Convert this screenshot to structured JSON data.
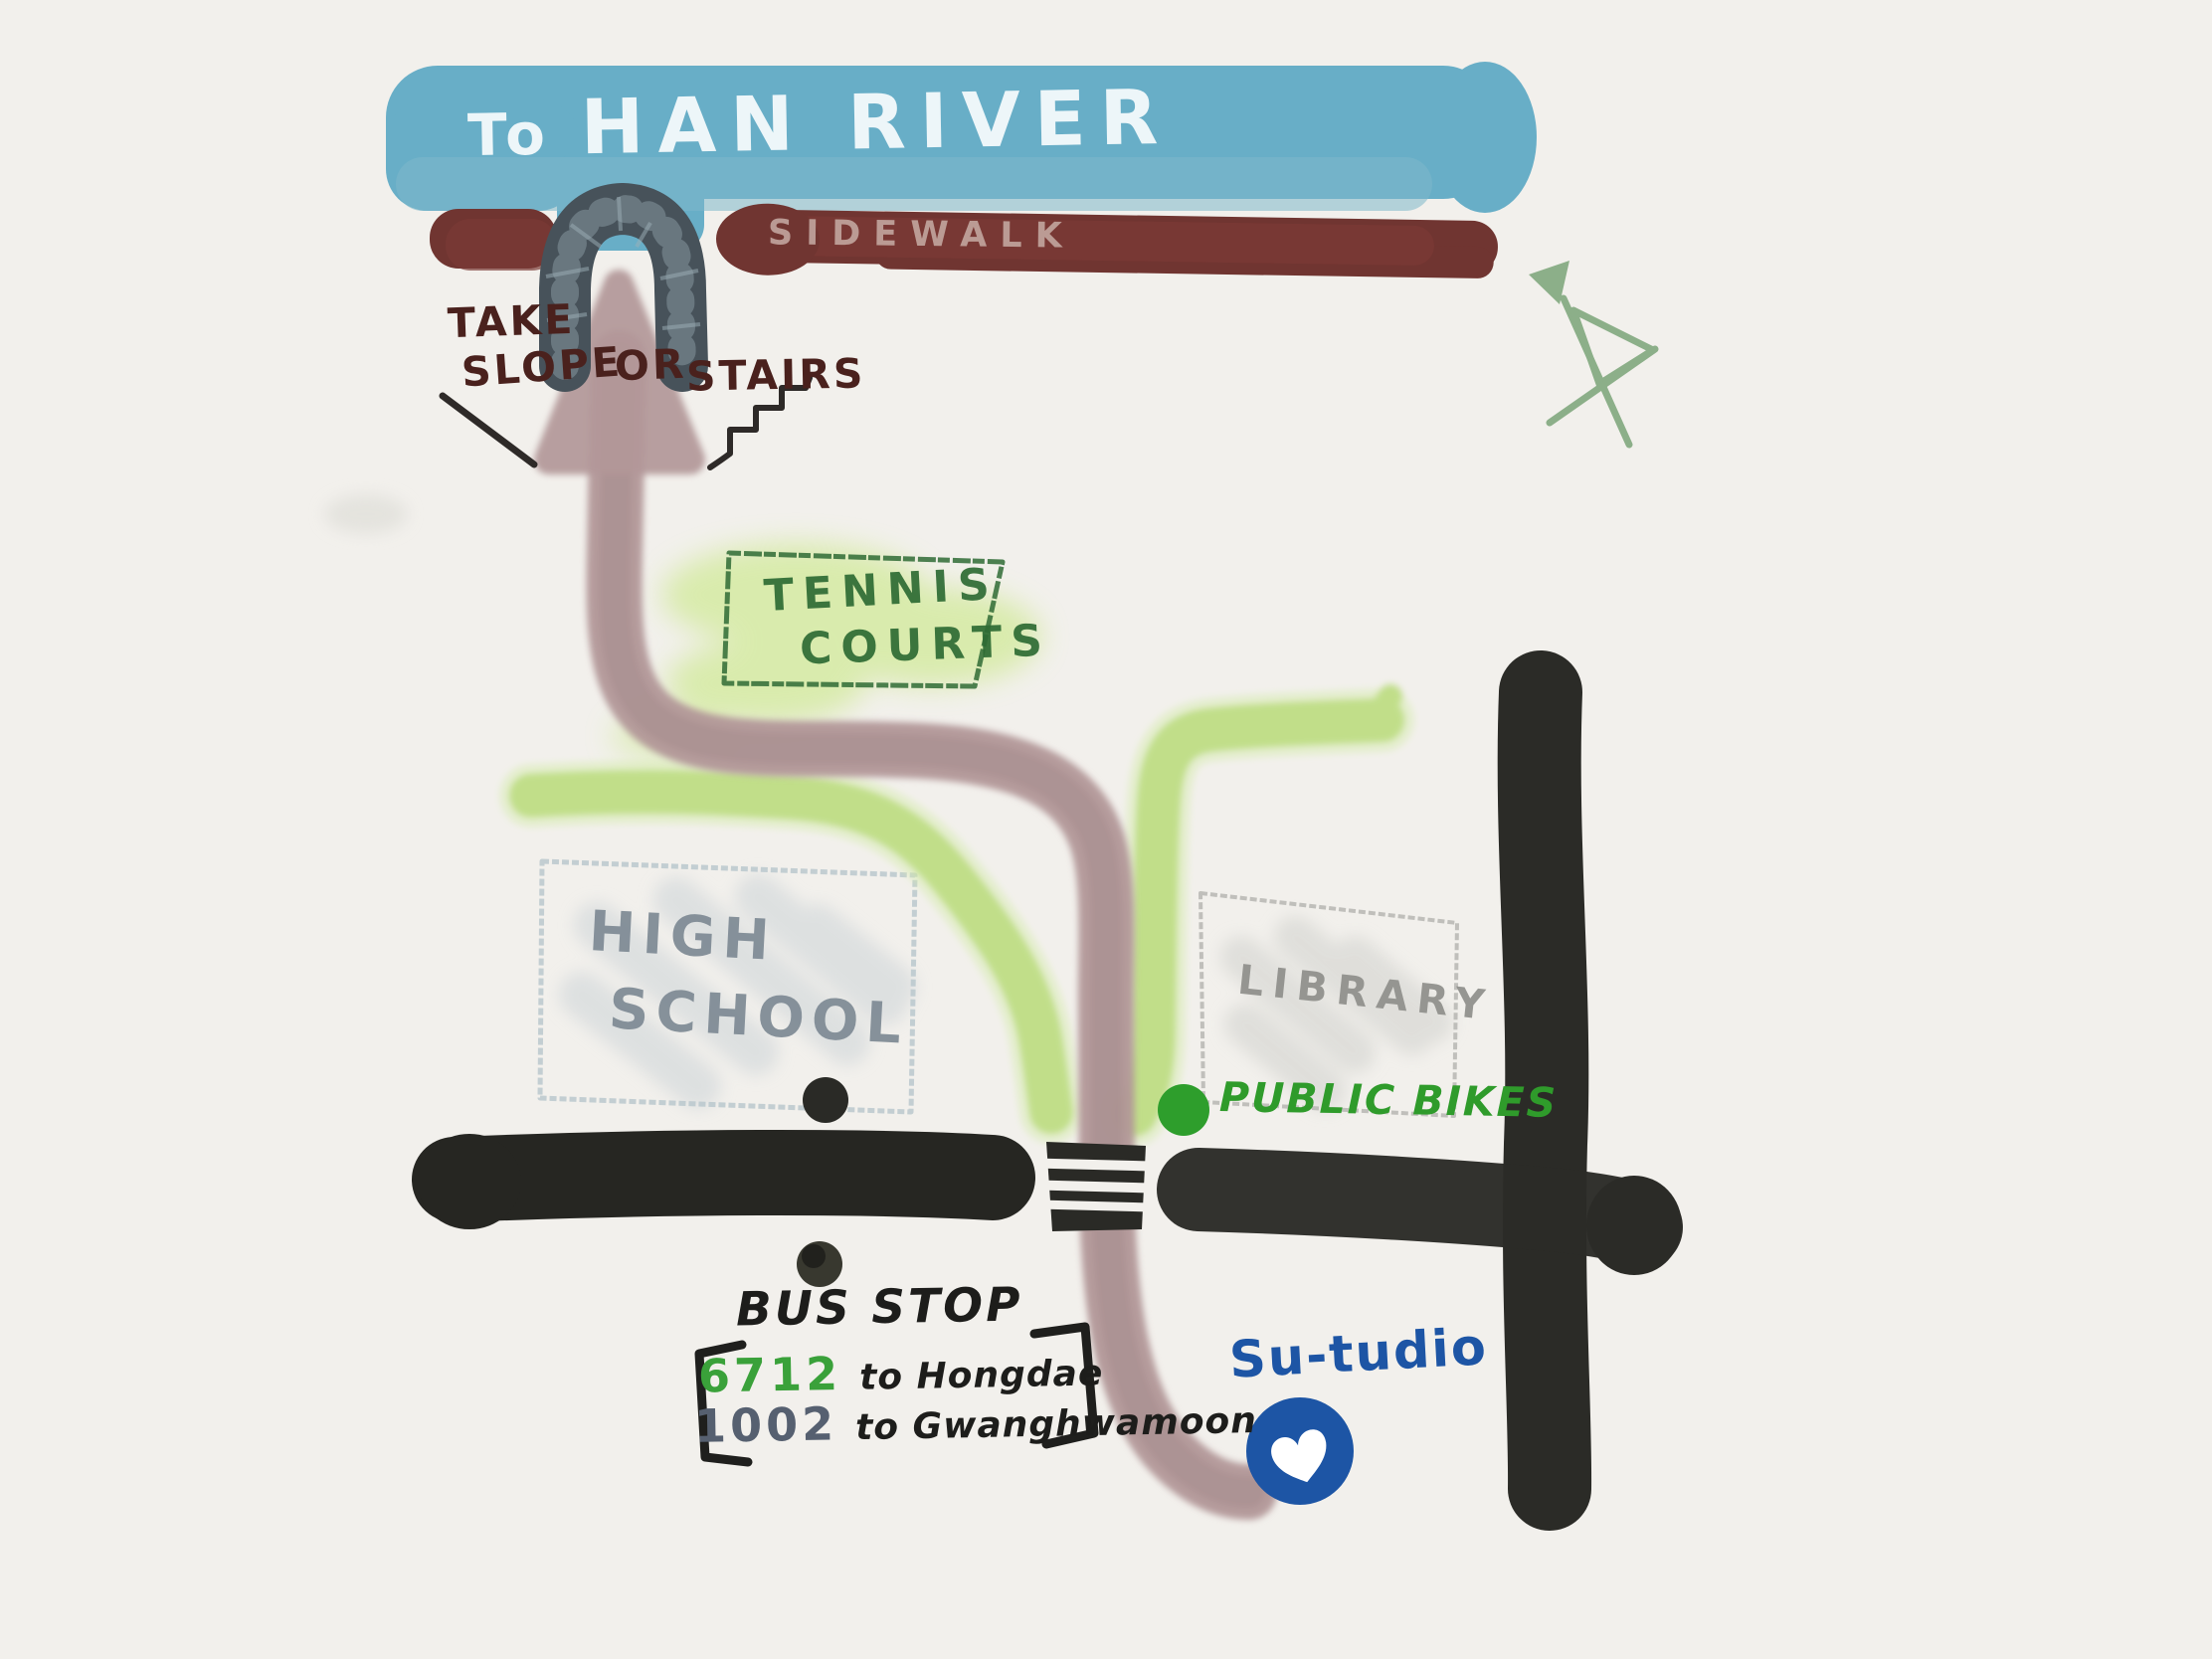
{
  "map": {
    "river": {
      "prefix": "To",
      "name": "HAN RIVER"
    },
    "sidewalk": {
      "label": "SIDEWALK"
    },
    "access_note": {
      "take": "TAKE",
      "slope": "SLOPE",
      "or": "OR",
      "stairs": "STAIRS"
    },
    "tennis_courts": {
      "line1": "TENNIS",
      "line2": "COURTS"
    },
    "high_school": {
      "line1": "HIGH",
      "line2": "SCHOOL"
    },
    "library": {
      "label": "LIBRARY"
    },
    "public_bikes": {
      "label": "PUBLIC BIKES"
    },
    "bus_stop": {
      "label": "BUS STOP",
      "routes": [
        {
          "number": "6712",
          "destination": "to Hongdae"
        },
        {
          "number": "1002",
          "destination": "to Gwanghwamoon"
        }
      ]
    },
    "studio": {
      "label": "Su-tudio"
    }
  },
  "icons": {
    "tunnel": "underpass-arch",
    "north_arrow": "compass-doodle",
    "heart": "♥",
    "crosswalk": "zebra-stripes",
    "bus_stop_dot": "●",
    "bike_station_dot": "●",
    "school_gate_dot": "●"
  },
  "colors": {
    "background": "#f2f0ec",
    "river_blue": "#68aec7",
    "sidewalk_maroon": "#703531",
    "tunnel_slate": "#47525a",
    "note_maroon": "#4a211d",
    "walk_path_pink": "#b29798",
    "bike_lane_green": "#bedd85",
    "tennis_green": "#2e6b34",
    "building_gray": "#7e8a94",
    "road_black": "#262622",
    "public_bikes_green": "#2f9b2b",
    "route_6712_green": "#3aa13a",
    "route_1002_slate": "#566070",
    "studio_blue": "#1d55a5",
    "compass_green": "#7ba478"
  }
}
